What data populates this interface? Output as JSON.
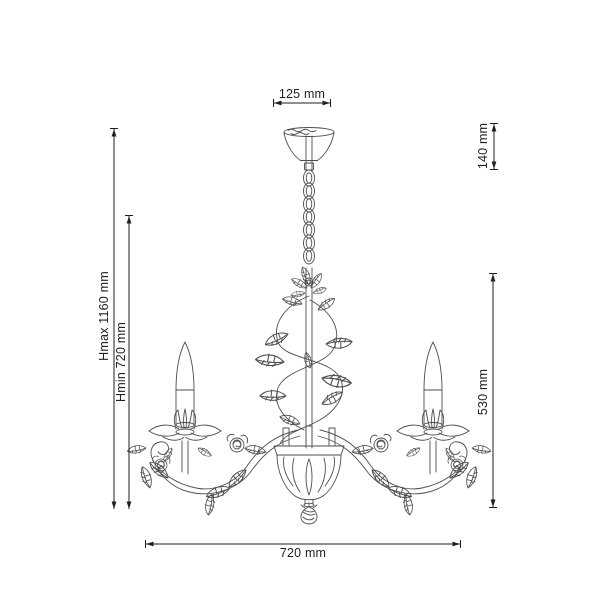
{
  "page": {
    "background": "#ffffff",
    "subject": "chandelier-technical-dimension-drawing"
  },
  "dimensions": {
    "top_width": {
      "label": "125 mm"
    },
    "canopy_height": {
      "label": "140 mm"
    },
    "max_height": {
      "label": "Hmax 1160 mm"
    },
    "min_height": {
      "label": "Hmin 720 mm"
    },
    "body_height": {
      "label": "530 mm"
    },
    "bottom_width": {
      "label": "720 mm"
    }
  },
  "colors": {
    "dimension_line": "#1f1f1f",
    "text": "#1f1f1f",
    "line_art": "#4d4d4d",
    "background": "#ffffff"
  }
}
